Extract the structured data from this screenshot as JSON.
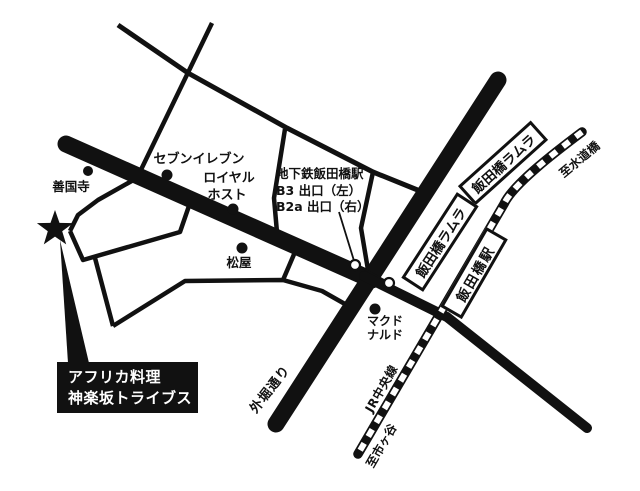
{
  "canvas": {
    "width": 640,
    "height": 491
  },
  "colors": {
    "ink": "#111111",
    "bg": "#ffffff"
  },
  "pois": {
    "seven_eleven": "セブンイレブン",
    "royal_host_line1": "ロイヤル",
    "royal_host_line2": "ホスト",
    "zenkokuji": "善国寺",
    "matsuya": "松屋",
    "mcdonalds_line1": "マクド",
    "mcdonalds_line2": "ナルド"
  },
  "subway_note": {
    "title": "地下鉄飯田橋駅",
    "exit_b3": "B3 出口（左）",
    "exit_b2a": "B2a 出口（右）"
  },
  "road_labels": {
    "sotobori_dori": "外堀通り",
    "jr_chuo_line": "JR中央線",
    "to_suidobashi": "至水道橋",
    "to_ichigaya": "至市ヶ谷"
  },
  "stations": {
    "ramla_upper": "飯田橋ラムラ",
    "ramla_lower": "飯田橋ラムラ",
    "iidabashi": "飯田橋駅"
  },
  "callout": {
    "line1": "アフリカ料理",
    "line2": "神楽坂トライブス"
  }
}
